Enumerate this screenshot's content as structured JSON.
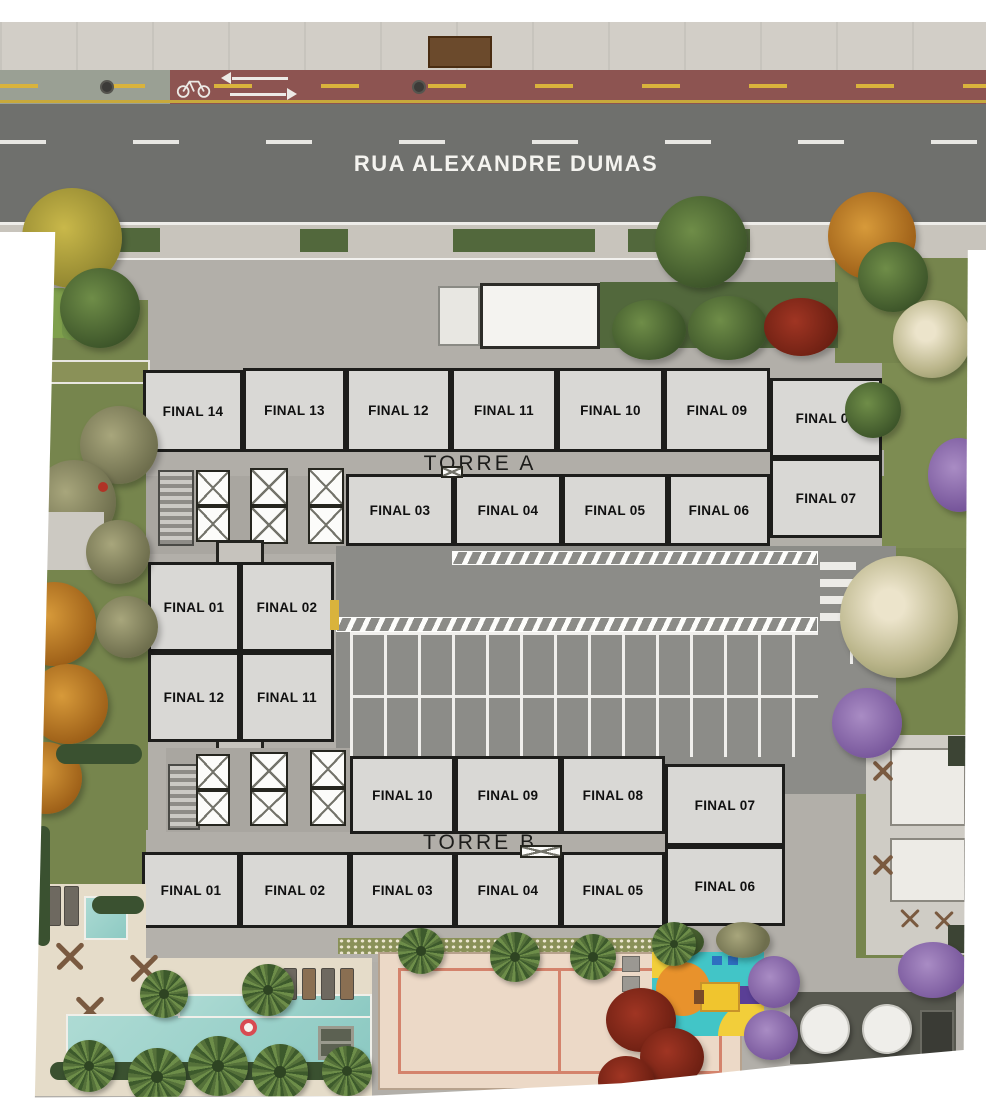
{
  "street": {
    "name": "RUA ALEXANDRE DUMAS"
  },
  "towers": {
    "torre_a": {
      "label": "TORRE A",
      "units": {
        "f01": "FINAL 01",
        "f02": "FINAL 02",
        "f03": "FINAL 03",
        "f04": "FINAL 04",
        "f05": "FINAL 05",
        "f06": "FINAL 06",
        "f07": "FINAL 07",
        "f08": "FINAL 08",
        "f09": "FINAL 09",
        "f10": "FINAL 10",
        "f11": "FINAL 11",
        "f12": "FINAL 12",
        "f13": "FINAL 13",
        "f14": "FINAL 14"
      }
    },
    "torre_b": {
      "label": "TORRE B",
      "units": {
        "f01": "FINAL 01",
        "f02": "FINAL 02",
        "f03": "FINAL 03",
        "f04": "FINAL 04",
        "f05": "FINAL 05",
        "f06": "FINAL 06",
        "f07": "FINAL 07",
        "f08": "FINAL 08",
        "f09": "FINAL 09",
        "f10": "FINAL 10",
        "f11": "FINAL 11",
        "f12": "FINAL 12"
      }
    }
  },
  "colors": {
    "road": "#6f706d",
    "bike_lane": "#8d5451",
    "lane_marking_yellow": "#d9b33c",
    "unit_fill": "#d9d8d5",
    "pool": "#9fd4cd",
    "sand_court": "#ecd9c7",
    "court_line": "#d4836c",
    "playground_base": "#42c5c7",
    "lawn": "#76854d"
  }
}
